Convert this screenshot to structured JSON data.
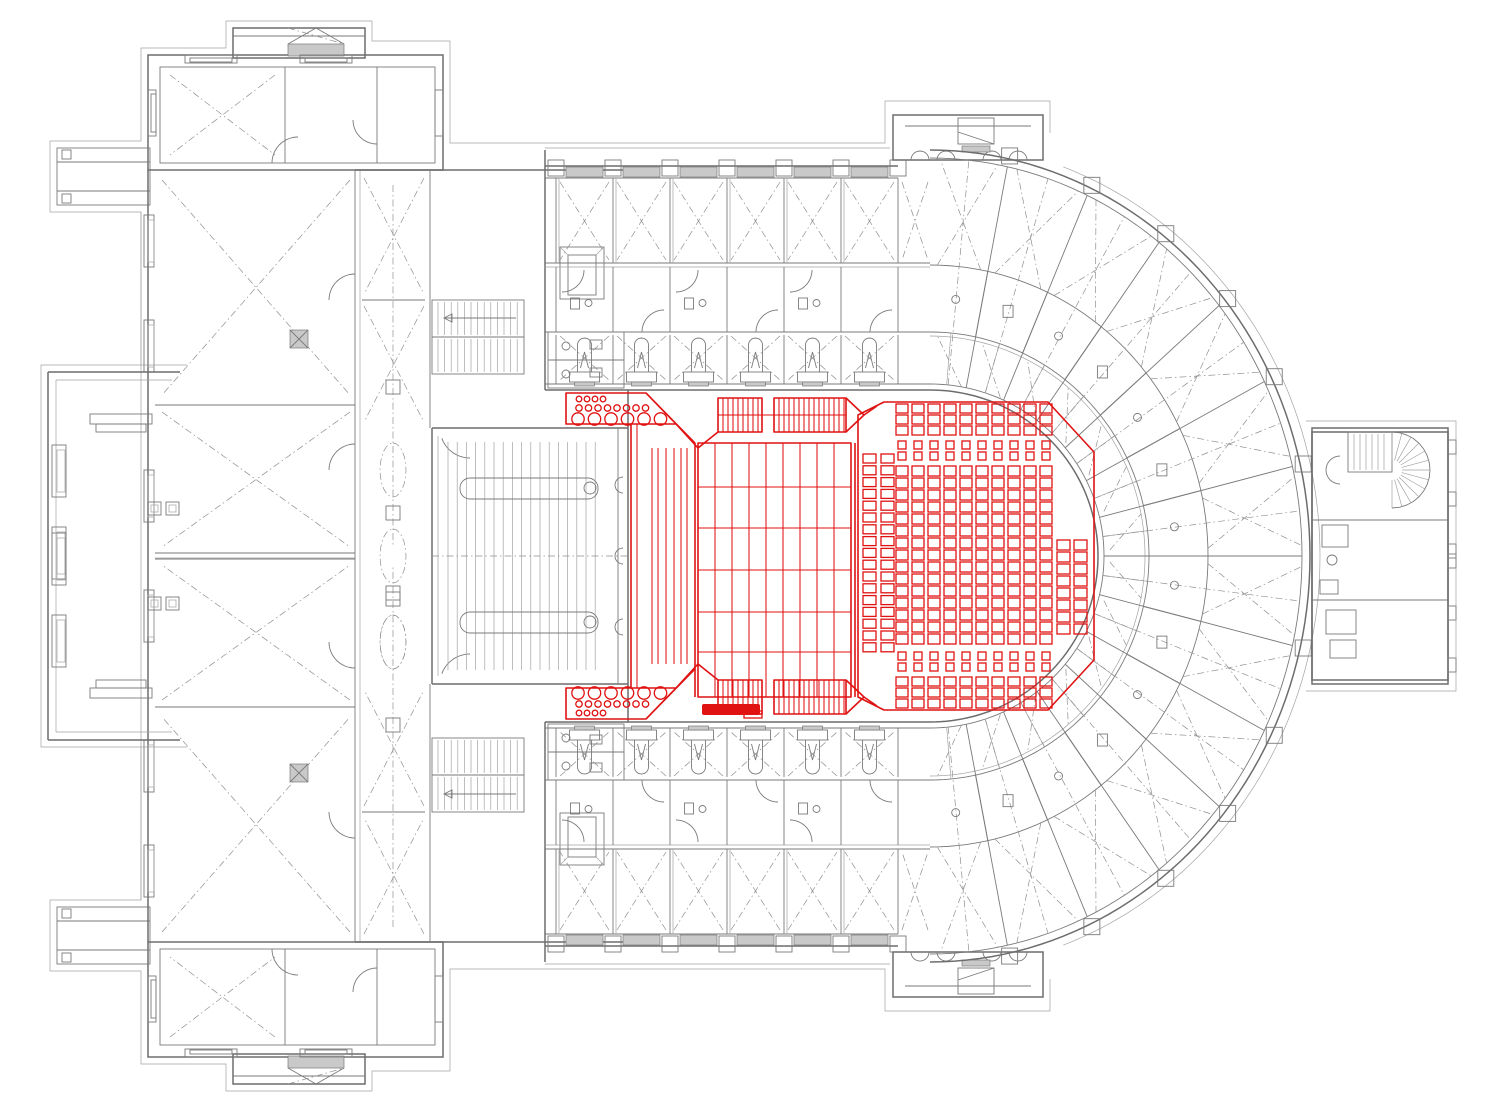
{
  "meta": {
    "description": "Theatre parterre-level architectural floor plan; auditorium seating, orchestra pit, side stairs and stage platform highlighted in red inside a grey CAD building drawing with stage house (left), horseshoe foyer ring (right), wing buildings and service rooms."
  },
  "colors": {
    "background": "#ffffff",
    "wall": "#7a7a7a",
    "wall_dark": "#6d6d6d",
    "wall_light": "#a3a3a3",
    "dash": "#8f8f8f",
    "wall_fill": "#c9c9c9",
    "highlight_red": "#e01212"
  },
  "highlight": {
    "zone_label": "auditorium-and-orchestra-highlight",
    "seating": {
      "left_block": {
        "columns": 2,
        "column_x": [
          863,
          881
        ],
        "seats_per_column": 17,
        "y_start": 454,
        "pitch": 11.8,
        "seat_w": 13,
        "seat_h": 9
      },
      "main_block": {
        "columns": 10,
        "x_start": 896,
        "x_pitch": 16,
        "seat_w": 12,
        "front_rows": 3,
        "front_y": 404,
        "front_pitch": 11,
        "front_h": 9,
        "mini_rows": 2,
        "mini_y": 441,
        "mini_pitch": 11,
        "mini_h": 8,
        "mid_rows": 15,
        "mid_y": 466,
        "mid_pitch": 12,
        "mid_h": 10
      },
      "right_block": {
        "columns": 2,
        "column_x": [
          1057,
          1074
        ],
        "seats_per_column": 8,
        "y_start": 540,
        "pitch": 12,
        "seat_w": 13,
        "seat_h": 10
      }
    },
    "orchestra_pit": {
      "rows": [
        {
          "y": 399,
          "r": 2.8,
          "count": 4,
          "x_start": 579,
          "pitch": 8
        },
        {
          "y": 408,
          "r": 3.2,
          "count": 8,
          "x_start": 579,
          "pitch": 9.5
        },
        {
          "y": 419,
          "r": 6.2,
          "count": 6,
          "x_start": 578,
          "pitch": 16.5
        }
      ]
    },
    "stage_platform": {
      "columns": 9,
      "row_lines": [
        487,
        528,
        570,
        612,
        652
      ],
      "x": 698,
      "y": 443,
      "w": 153,
      "h": 254
    },
    "stair_strips": {
      "tread_step": 5,
      "runs": [
        [
          718,
          762
        ],
        [
          774,
          846
        ]
      ],
      "y": 398,
      "h": 34
    }
  },
  "building": {
    "horseshoe": {
      "radial_wall_angles_deg": [
        13,
        26,
        39,
        52,
        65,
        78
      ],
      "loge_divider_step_deg": 6.5,
      "bands": 3
    },
    "corridor_modules": {
      "x_start": 556,
      "x_end": 898,
      "pitch": 57
    },
    "stage_boards": {
      "count": 17,
      "x_start": 448,
      "step": 9.2
    },
    "wing_window_rows_y": [
      215,
      320,
      470
    ],
    "protrusion_window_rows_y": [
      445,
      527
    ]
  }
}
